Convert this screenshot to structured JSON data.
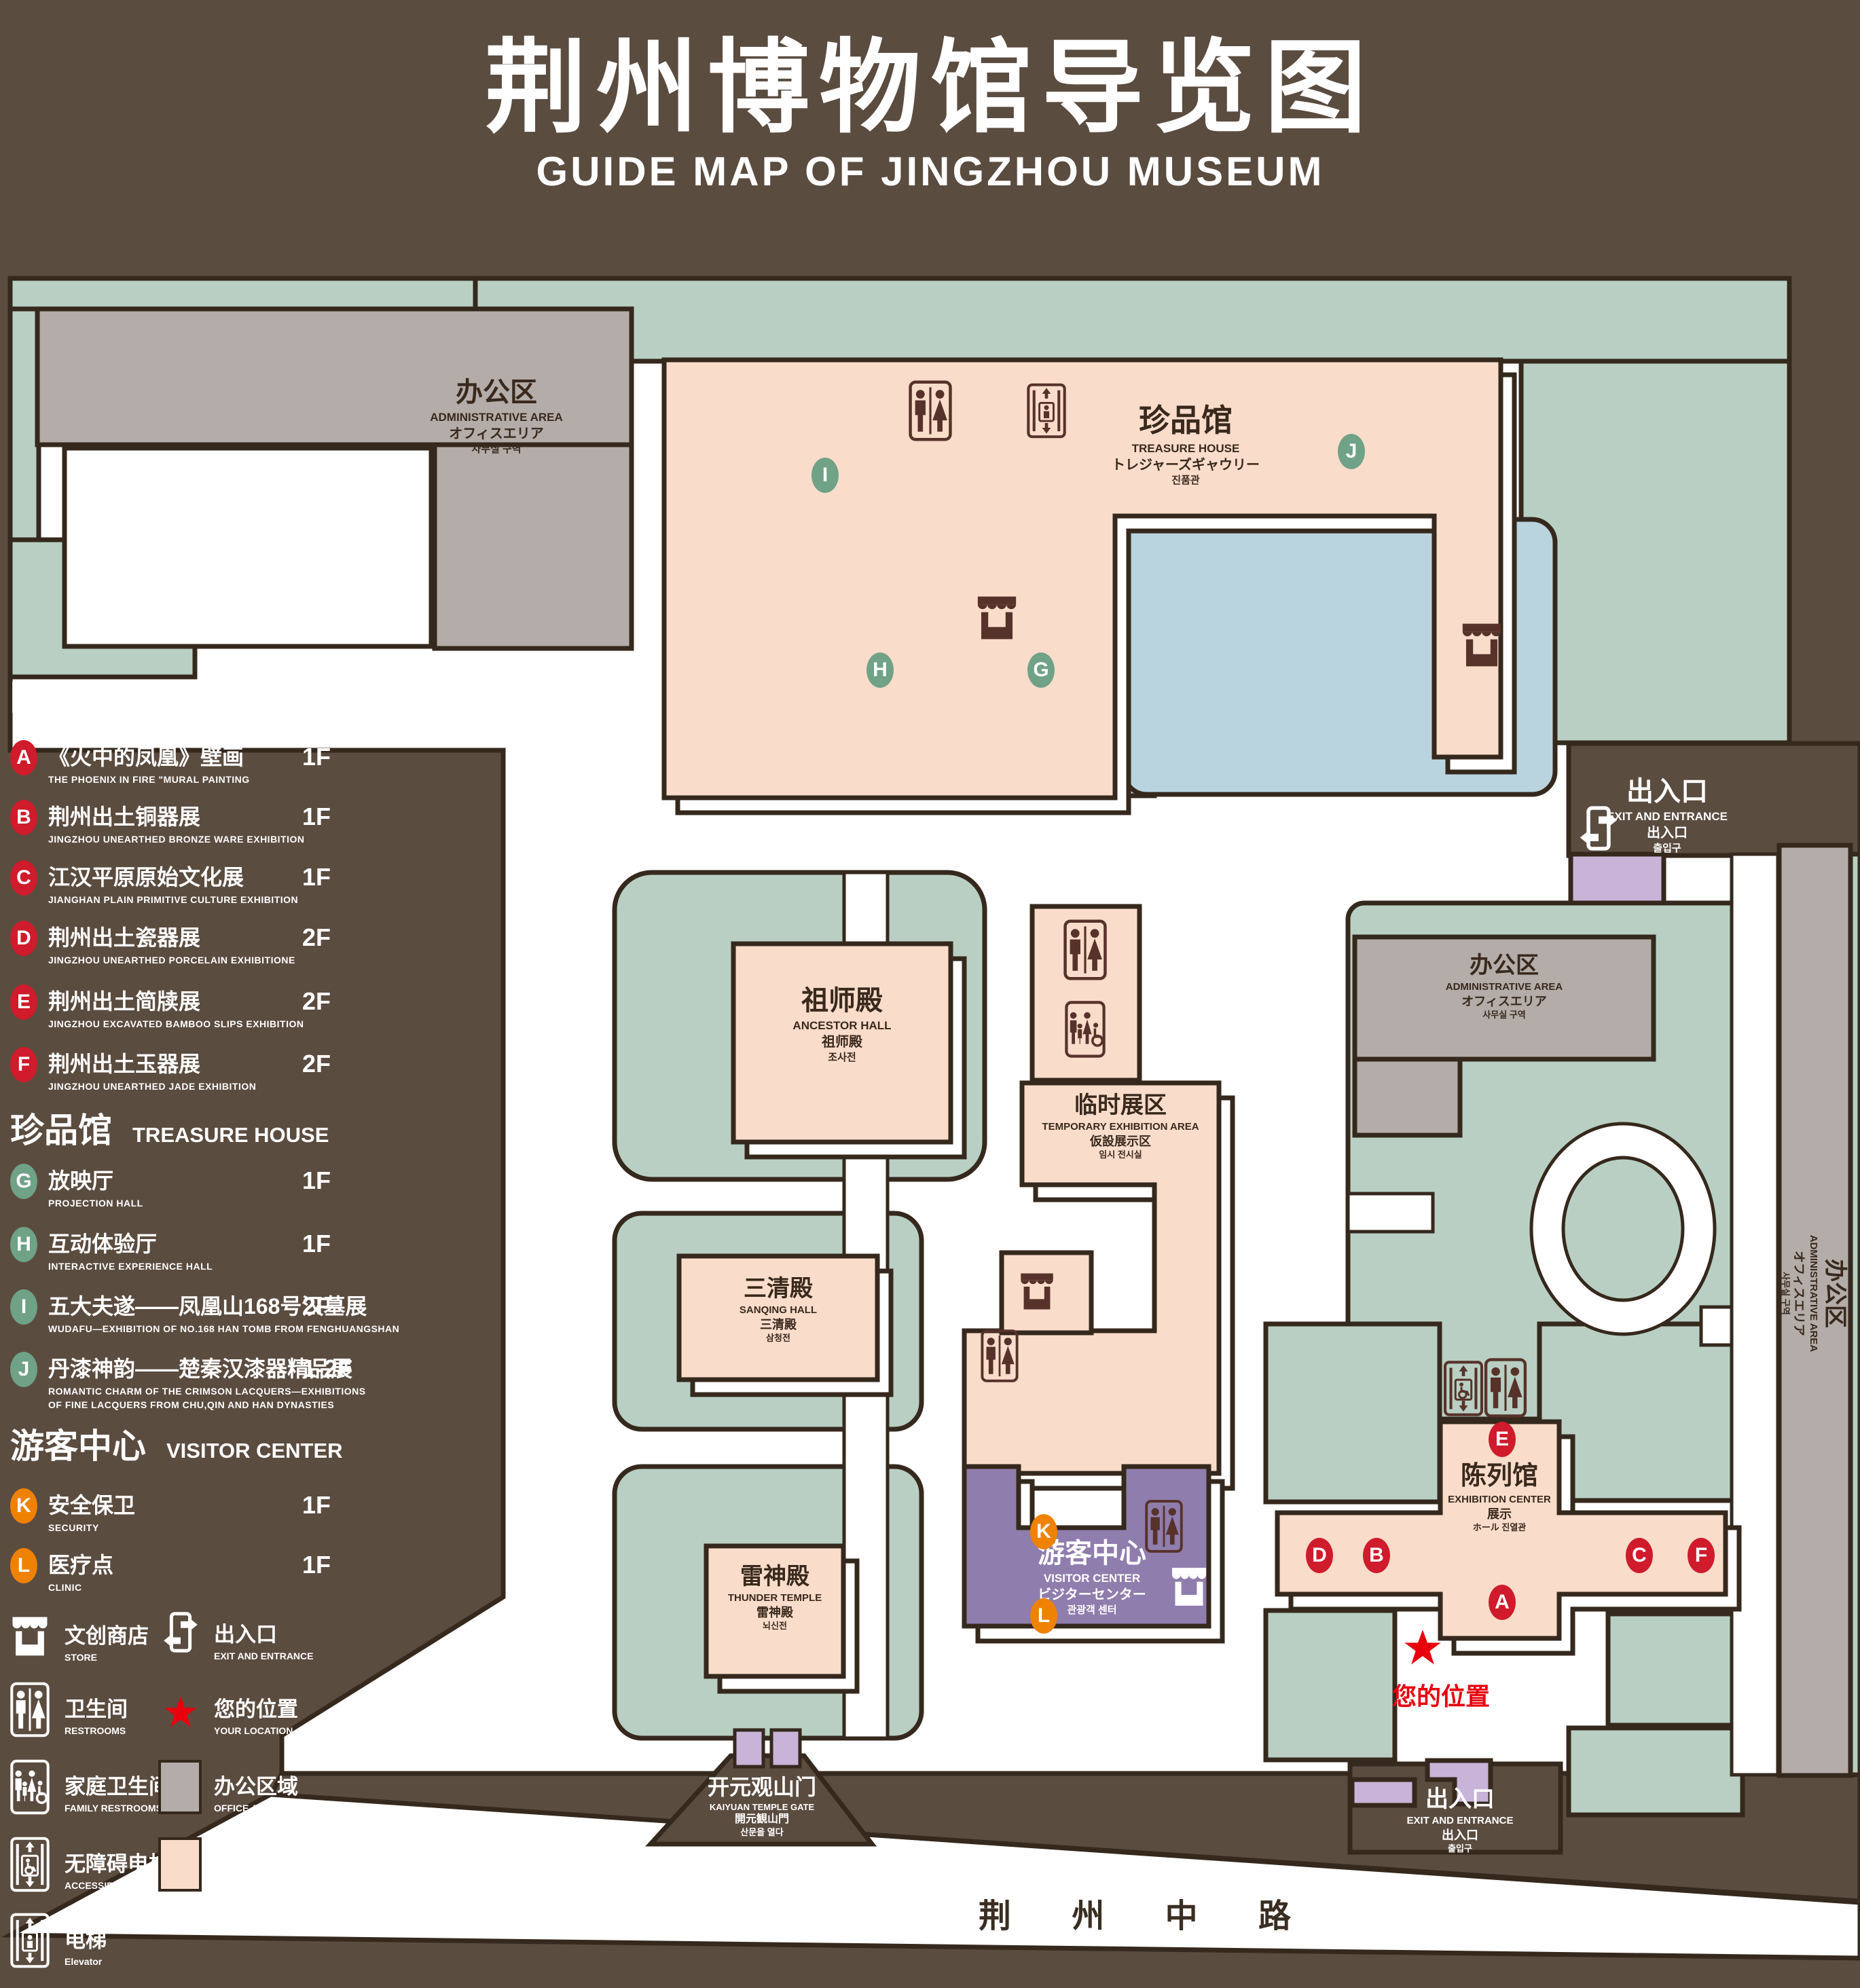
{
  "title": {
    "zh": "荆州博物馆导览图",
    "en": "GUIDE MAP OF JINGZHOU MUSEUM"
  },
  "legend": {
    "sections": [
      {
        "zh": "陈列馆",
        "en": "EXHIBITION CENTER",
        "items": [
          {
            "id": "A",
            "zh": "《火中的凤凰》壁画",
            "en": "THE PHOENIX IN FIRE \"MURAL PAINTING",
            "floor": "1F"
          },
          {
            "id": "B",
            "zh": "荆州出土铜器展",
            "en": "JINGZHOU UNEARTHED BRONZE WARE EXHIBITION",
            "floor": "1F"
          },
          {
            "id": "C",
            "zh": "江汉平原原始文化展",
            "en": "JIANGHAN PLAIN PRIMITIVE CULTURE EXHIBITION",
            "floor": "1F"
          },
          {
            "id": "D",
            "zh": "荆州出土瓷器展",
            "en": "JINGZHOU UNEARTHED PORCELAIN EXHIBITIONE",
            "floor": "2F"
          },
          {
            "id": "E",
            "zh": "荆州出土简牍展",
            "en": "JINGZHOU EXCAVATED BAMBOO SLIPS EXHIBITION",
            "floor": "2F"
          },
          {
            "id": "F",
            "zh": "荆州出土玉器展",
            "en": "JINGZHOU UNEARTHED JADE EXHIBITION",
            "floor": "2F"
          }
        ]
      },
      {
        "zh": "珍品馆",
        "en": "TREASURE HOUSE",
        "items": [
          {
            "id": "G",
            "zh": "放映厅",
            "en": "PROJECTION HALL",
            "floor": "1F"
          },
          {
            "id": "H",
            "zh": "互动体验厅",
            "en": "INTERACTIVE EXPERIENCE HALL",
            "floor": "1F"
          },
          {
            "id": "I",
            "zh": "五大夫遂——凤凰山168号汉墓展",
            "en": "WUDAFU—EXHIBITION OF NO.168 HAN TOMB FROM FENGHUANGSHAN",
            "floor": "2F"
          },
          {
            "id": "J",
            "zh": "丹漆神韵——楚秦汉漆器精品展",
            "en": "ROMANTIC CHARM OF THE CRIMSON LACQUERS—EXHIBITIONS",
            "en2": "OF FINE LACQUERS FROM CHU,QIN AND HAN DYNASTIES",
            "floor": "1-2F"
          }
        ]
      },
      {
        "zh": "游客中心",
        "en": "VISITOR CENTER",
        "items": [
          {
            "id": "K",
            "zh": "安全保卫",
            "en": "SECURITY",
            "floor": "1F"
          },
          {
            "id": "L",
            "zh": "医疗点",
            "en": "CLINIC",
            "floor": "1F"
          }
        ]
      }
    ],
    "symbols": {
      "store": {
        "zh": "文创商店",
        "en": "STORE"
      },
      "exit": {
        "zh": "出入口",
        "en": "EXIT AND ENTRANCE"
      },
      "restrooms": {
        "zh": "卫生间",
        "en": "RESTROOMS"
      },
      "location": {
        "zh": "您的位置",
        "en": "YOUR LOCATION"
      },
      "family": {
        "zh": "家庭卫生间",
        "en": "FAMILY RESTROOMS"
      },
      "office": {
        "zh": "办公区域",
        "en": "OFFICE AREA"
      },
      "accessible": {
        "zh": "无障碍电梯",
        "en": "ACCESSIBLE ELEVATOR"
      },
      "display": {
        "zh": "展示区域",
        "en": "DISPLAY AREA"
      },
      "elevator": {
        "zh": "电梯",
        "en": "Elevator"
      }
    }
  },
  "map": {
    "admin": {
      "zh": "办公区",
      "en": "ADMINISTRATIVE AREA",
      "ja": "オフィスエリア",
      "ko": "사무실 구역"
    },
    "treasure": {
      "zh": "珍品馆",
      "en": "TREASURE HOUSE",
      "ja": "トレジャーズギャウリー",
      "ko": "진품관"
    },
    "ancestor": {
      "zh": "祖师殿",
      "en": "ANCESTOR HALL",
      "ja": "祖师殿",
      "ko": "조사전"
    },
    "temporary": {
      "zh": "临时展区",
      "en": "TEMPORARY EXHIBITION AREA",
      "ja": "仮設展示区",
      "ko": "임시 전시실"
    },
    "sanqing": {
      "zh": "三清殿",
      "en": "SANQING HALL",
      "ja": "三清殿",
      "ko": "삼청전"
    },
    "thunder": {
      "zh": "雷神殿",
      "en": "THUNDER TEMPLE",
      "ja": "雷神殿",
      "ko": "뇌신전"
    },
    "exhibition": {
      "zh": "陈列馆",
      "en": "EXHIBITION CENTER",
      "ja": "展示",
      "ko": "ホール 진열관"
    },
    "visitor": {
      "zh": "游客中心",
      "en": "VISITOR CENTER",
      "ja": "ビジターセンター",
      "ko": "관광객 센터"
    },
    "exit": {
      "zh": "出入口",
      "en": "EXIT AND ENTRANCE",
      "ja": "出入口",
      "ko": "출입구"
    },
    "gate": {
      "zh": "开元观山门",
      "en": "KAIYUAN TEMPLE GATE",
      "ja": "開元観山門",
      "ko": "산문을 열다"
    },
    "road": {
      "zh": "荆 州 中 路"
    },
    "location": {
      "zh": "您的位置"
    }
  },
  "colors": {
    "background": "#5b4c40",
    "lawn": "#b9cfc3",
    "display_area": "#f9dcca",
    "office_area": "#b3aca8",
    "pond": "#b9d4df",
    "visitor_center": "#8f7dad",
    "gate_structure": "#c7b4d8",
    "marker_red": "#cf1b2b",
    "marker_green": "#6fa287",
    "marker_orange": "#ef8200",
    "location_red": "#e8000d",
    "outline": "#35281c"
  }
}
